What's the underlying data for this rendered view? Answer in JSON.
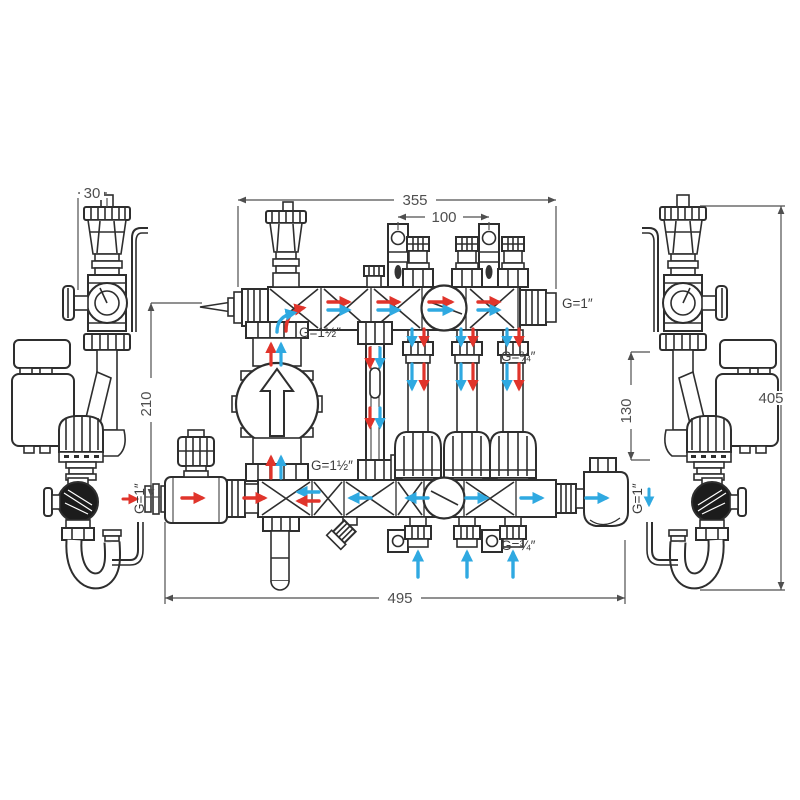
{
  "drawing": {
    "kind": "Technical dimensioned drawing - heating manifold with mixing pump group (front view with left and right side views)",
    "colors": {
      "line": "#2e2e2e",
      "dimension": "#4f4f4f",
      "supply_flow": "#e0342b",
      "return_flow": "#2fa9e1",
      "background": "#ffffff"
    },
    "dimensions": {
      "offset_30": "30",
      "width_355": "355",
      "spacing_100": "100",
      "height_210": "210",
      "spacing_130": "130",
      "height_405": "405",
      "width_495": "495"
    },
    "labels": {
      "pump_top": "G=1½″",
      "pump_bottom": "G=1½″",
      "manifold_right_end": "G=1″",
      "upper_outlets": "G=¾″",
      "lower_outlets": "G=¾″",
      "left_inlet": "G=1″",
      "right_outlet": "G=1″"
    }
  }
}
